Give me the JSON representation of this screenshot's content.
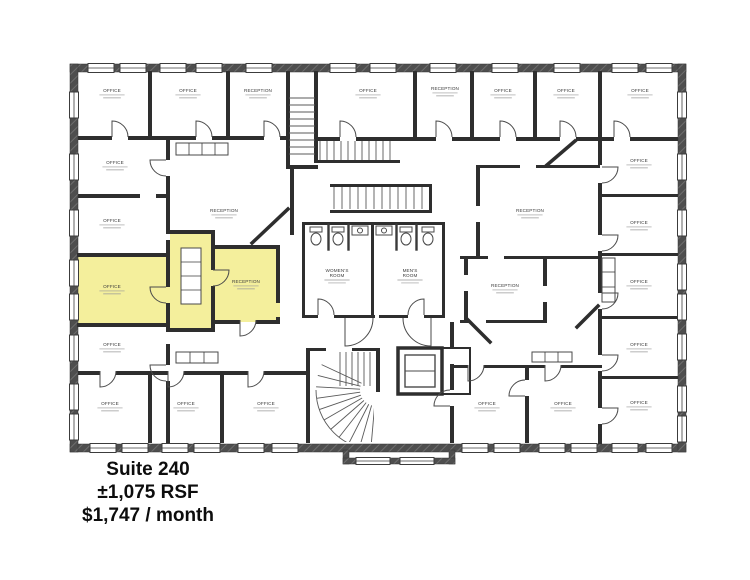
{
  "listing": {
    "suite": "Suite 240",
    "size": "±1,075 RSF",
    "price": "$1,747 / month"
  },
  "palette": {
    "exterior_wall": "#4e4e4e",
    "interior_wall": "#2e2e2e",
    "highlight": "#f4ef9c",
    "background": "#ffffff",
    "dim_text": "#999999"
  },
  "floor_plan": {
    "highlighted_suite": "Suite 240",
    "rooms": [
      {
        "label": "OFFICE",
        "x": 112,
        "y": 92
      },
      {
        "label": "OFFICE",
        "x": 188,
        "y": 92
      },
      {
        "label": "RECEPTION",
        "x": 258,
        "y": 92
      },
      {
        "label": "OFFICE",
        "x": 368,
        "y": 92
      },
      {
        "label": "RECEPTION",
        "x": 445,
        "y": 90
      },
      {
        "label": "OFFICE",
        "x": 503,
        "y": 92
      },
      {
        "label": "OFFICE",
        "x": 566,
        "y": 92
      },
      {
        "label": "OFFICE",
        "x": 640,
        "y": 92
      },
      {
        "label": "OFFICE",
        "x": 115,
        "y": 164
      },
      {
        "label": "OFFICE",
        "x": 112,
        "y": 222
      },
      {
        "label": "RECEPTION",
        "x": 224,
        "y": 212
      },
      {
        "label": "OFFICE",
        "x": 112,
        "y": 288,
        "highlighted": true
      },
      {
        "label": "RECEPTION",
        "x": 246,
        "y": 283,
        "highlighted": true
      },
      {
        "label": "OFFICE",
        "x": 112,
        "y": 346
      },
      {
        "label": "OFFICE",
        "x": 110,
        "y": 405
      },
      {
        "label": "OFFICE",
        "x": 186,
        "y": 405
      },
      {
        "label": "OFFICE",
        "x": 266,
        "y": 405
      },
      {
        "label": "RECEPTION",
        "x": 530,
        "y": 212
      },
      {
        "label": "RECEPTION",
        "x": 505,
        "y": 287
      },
      {
        "label": "OFFICE",
        "x": 487,
        "y": 405
      },
      {
        "label": "OFFICE",
        "x": 563,
        "y": 405
      },
      {
        "label": "OFFICE",
        "x": 639,
        "y": 162
      },
      {
        "label": "OFFICE",
        "x": 639,
        "y": 224
      },
      {
        "label": "OFFICE",
        "x": 639,
        "y": 283
      },
      {
        "label": "OFFICE",
        "x": 639,
        "y": 346
      },
      {
        "label": "OFFICE",
        "x": 639,
        "y": 404
      },
      {
        "label": "WOMEN'S ROOM",
        "x": 337,
        "y": 272
      },
      {
        "label": "MEN'S ROOM",
        "x": 410,
        "y": 272
      }
    ],
    "windows": {
      "top": [
        88,
        120,
        160,
        196,
        246,
        330,
        370,
        430,
        492,
        554,
        612,
        646
      ],
      "bottom": [
        90,
        122,
        162,
        194,
        238,
        272,
        462,
        494,
        539,
        571,
        612,
        646
      ],
      "left": [
        92,
        154,
        210,
        260,
        294,
        335,
        384,
        414
      ],
      "right": [
        92,
        154,
        210,
        264,
        294,
        334,
        386,
        416
      ],
      "bay": [
        356,
        400
      ]
    }
  }
}
